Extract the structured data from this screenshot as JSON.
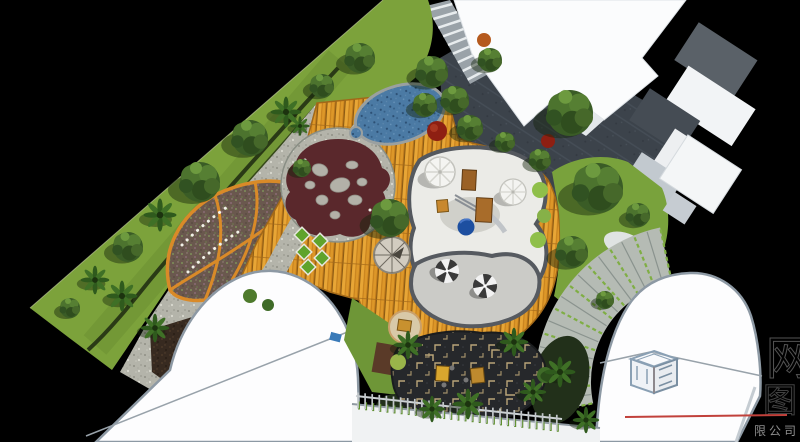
{
  "canvas": {
    "background": "#000000"
  },
  "palette": {
    "lawn_green": "#7CA23B",
    "lawn_shade": "#6B8F32",
    "tree_canopy": "#3A5C26",
    "palm_leaf": "#2F5A1D",
    "gravel_gray": "#B4B4AA",
    "deck_orange": "#DD9728",
    "deck_seam": "#8A5A14",
    "flowerbed_border_orange": "#D98A28",
    "flowerbed_soil": "#6A584E",
    "turtle_mosaic_maroon": "#5A282C",
    "mosaic_stone_gray": "#B3B1A8",
    "pond_blue": "#4B7AA4",
    "sand_white": "#EBEBE7",
    "plaza_gray": "#CBCBC7",
    "dark_paving": "#3C434B",
    "courtyard_charcoal": "#26282B",
    "maze_tan": "#B9A478",
    "building_white": "#FDFDFE",
    "building_outline": "#8D99A4",
    "fan_step_green": "#7FAE44",
    "umbrella_stripe_dark": "#3A3A3A",
    "slide_blue": "#1D4FA0",
    "equipment_wood": "#9A6126",
    "red_maple": "#8E1F12",
    "diamond_tile_green": "#5FA32C"
  },
  "watermark": {
    "company_text": "限公司",
    "glyph_top": "网",
    "glyph_bottom": "图",
    "line_color": "#C1413B",
    "text_color": "#8F8F8F",
    "logo": "cube-frame-logo"
  }
}
